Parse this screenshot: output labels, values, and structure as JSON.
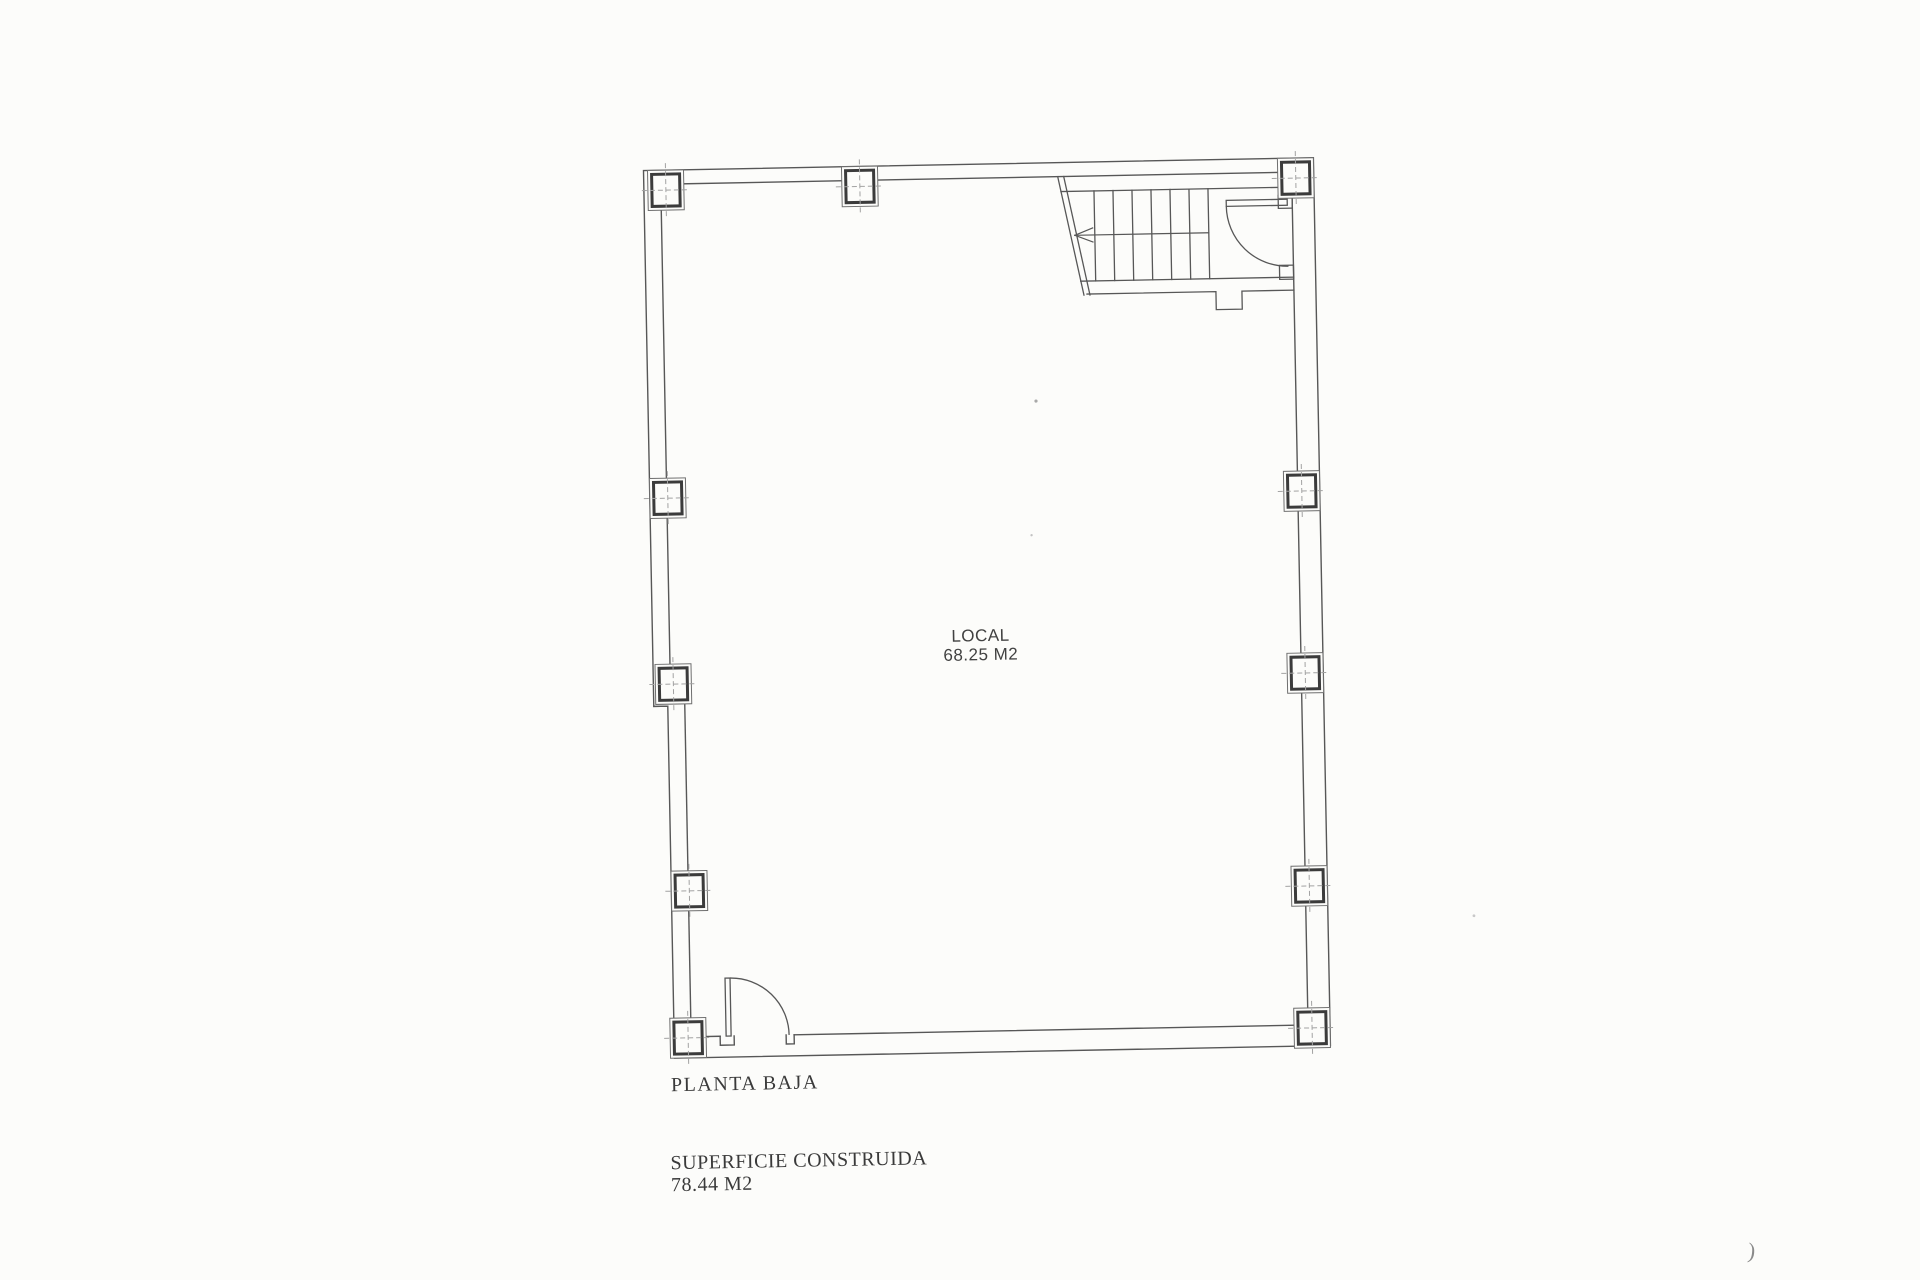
{
  "page": {
    "background": "#fcfcfa",
    "corner_mark": ")"
  },
  "plan": {
    "title": "PLANTA BAJA",
    "room": {
      "label": "LOCAL",
      "area": "68.25 M2"
    },
    "summary": {
      "label": "SUPERFICIE CONSTRUIDA",
      "value": "78.44 M2"
    },
    "drawing": {
      "wall_line_color": "#575757",
      "column_line_color": "#3b3b3b",
      "centerline_color": "#a2a2a2",
      "stair_step_count": 7,
      "stair_arrow_direction": "left",
      "door_count": 2
    }
  }
}
